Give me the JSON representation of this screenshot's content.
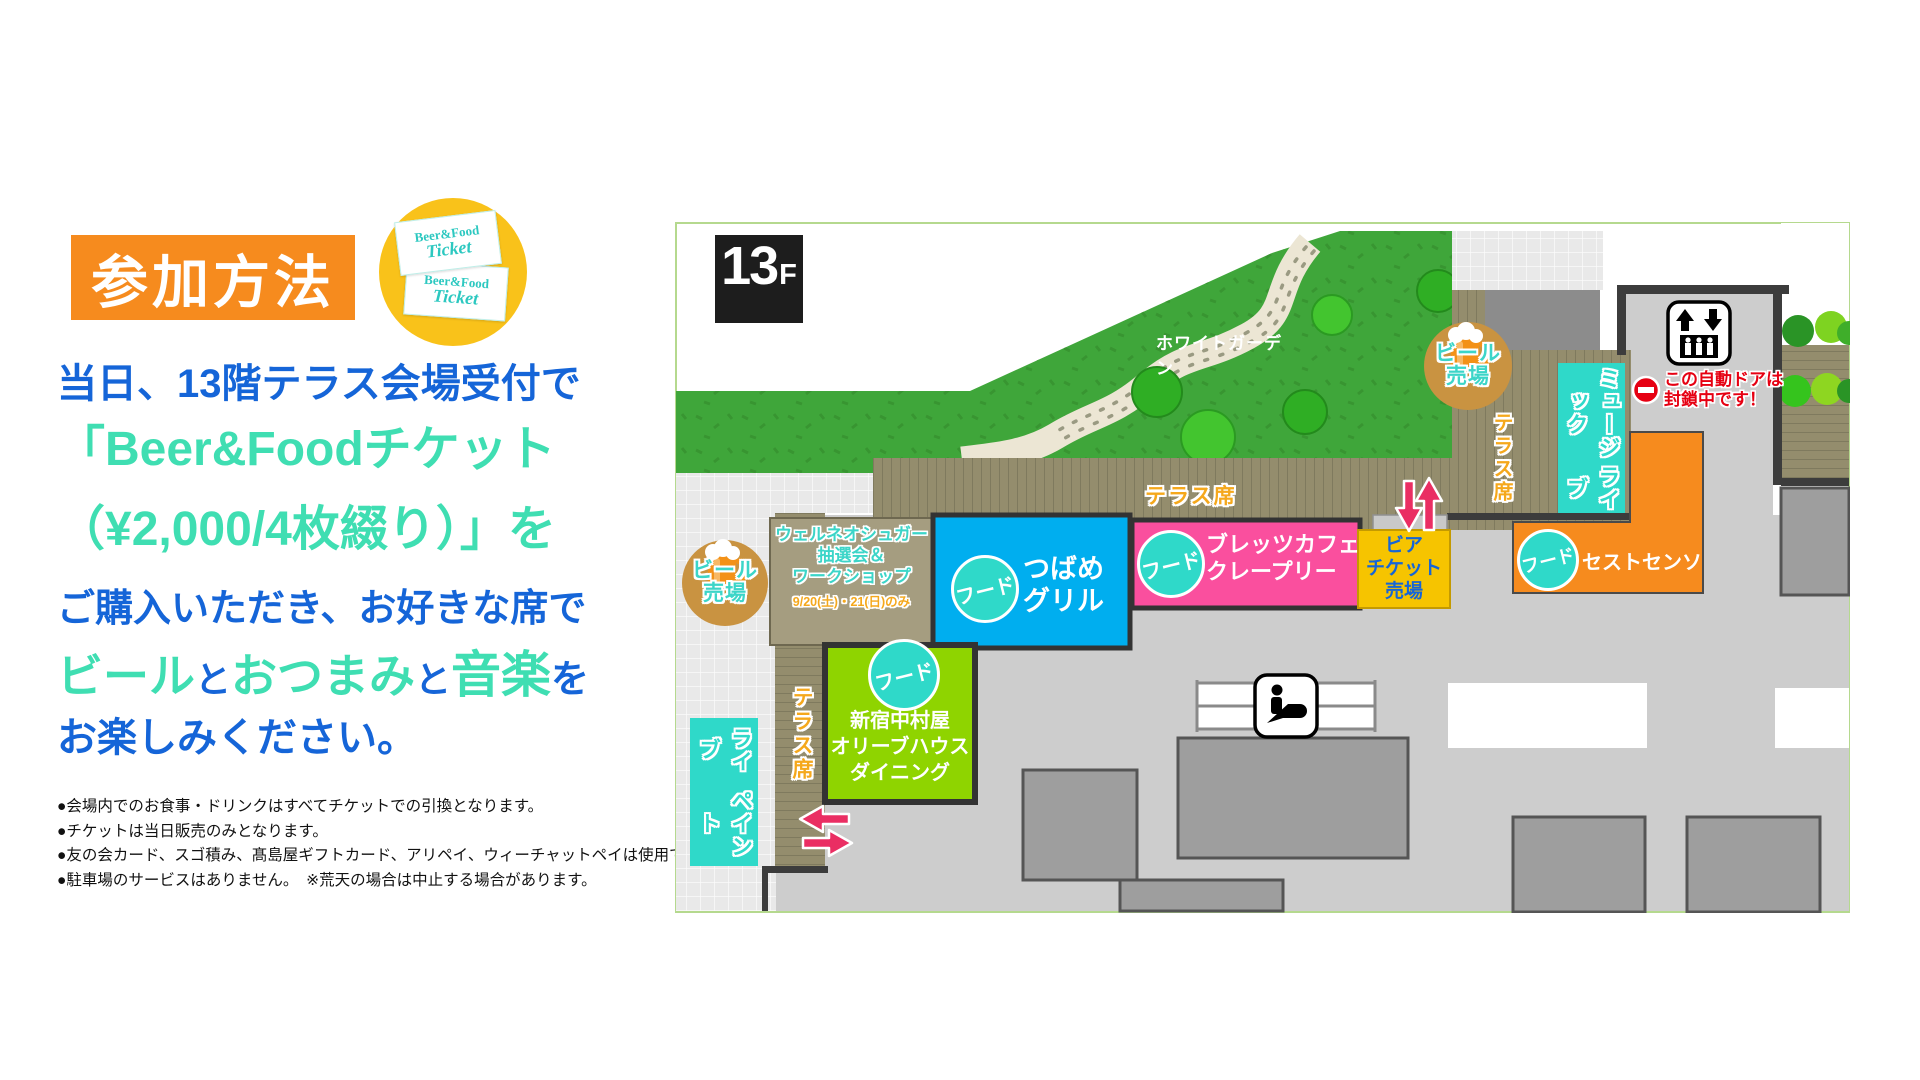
{
  "left_panel": {
    "badge_label": "参加方法",
    "ticket_circle": {
      "card_line1": "Beer&Food",
      "card_line2": "Ticket"
    },
    "headline": {
      "line1": "当日、13階テラス会場受付で",
      "line2": "「Beer&Foodチケット",
      "line3": "（¥2,000/4枚綴り）」を",
      "line4": "ご購入いただき、お好きな席で",
      "line5_segments": [
        {
          "text": "ビール",
          "color": "mint"
        },
        {
          "text": "と",
          "color": "blue"
        },
        {
          "text": "おつまみ",
          "color": "mint"
        },
        {
          "text": "と",
          "color": "blue"
        },
        {
          "text": "音楽",
          "color": "mint"
        },
        {
          "text": "を",
          "color": "blue"
        }
      ],
      "line6": "お楽しみください。"
    },
    "notes": [
      "●会場内でのお食事・ドリンクはすべてチケットでの引換となります。",
      "●チケットは当日販売のみとなります。",
      "●友の会カード、スゴ積み、髙島屋ギフトカード、アリペイ、ウィーチャットペイは使用できません。",
      "●駐車場のサービスはありません。　※荒天の場合は中止する場合があります。"
    ]
  },
  "map": {
    "floor_badge": {
      "num": "13",
      "f": "F"
    },
    "garden_label": "ホワイトガーデン",
    "terrace_label": "テラス席",
    "beer_stand": {
      "line1": "ビール",
      "line2": "売場"
    },
    "wellneo": {
      "line1": "ウェルネオシュガー",
      "line2": "抽選会＆",
      "line3": "ワークショップ",
      "date": "9/20(土)・21(日)のみ"
    },
    "food_badge": "フード",
    "shops": {
      "tsubame": {
        "line1": "つばめ",
        "line2": "グリル"
      },
      "bretz": {
        "line1": "ブレッツカフェ",
        "line2": "クレープリー"
      },
      "nakamuraya": {
        "line1": "新宿中村屋",
        "line2": "オリーブハウス",
        "line3": "ダイニング"
      },
      "sesto": {
        "name": "セストセンソ"
      }
    },
    "beer_ticket_booth": {
      "line1": "ビア",
      "line2": "チケット",
      "line3": "売場"
    },
    "music_live": {
      "line1": "ミュージック",
      "line2": "ライブ"
    },
    "live_paint": {
      "line1": "ライブ",
      "line2": "ペイント"
    },
    "door_notice": {
      "line1": "この自動ドアは",
      "line2": "封鎖中です！"
    }
  },
  "colors": {
    "blue": "#1565d8",
    "mint": "#3fdeb2",
    "orange_badge": "#f68b1e",
    "gold": "#f9c21a",
    "teal": "#2fd9c9",
    "garden_green": "#3fa63a",
    "shop_pink": "#fa4f9e",
    "shop_sky": "#00aeef",
    "shop_lime": "#8fd400",
    "booth_yellow": "#f6c400",
    "alert_red": "#e60012",
    "deck_khaki": "#948d6d",
    "floor_gray": "#cdcdcd"
  }
}
